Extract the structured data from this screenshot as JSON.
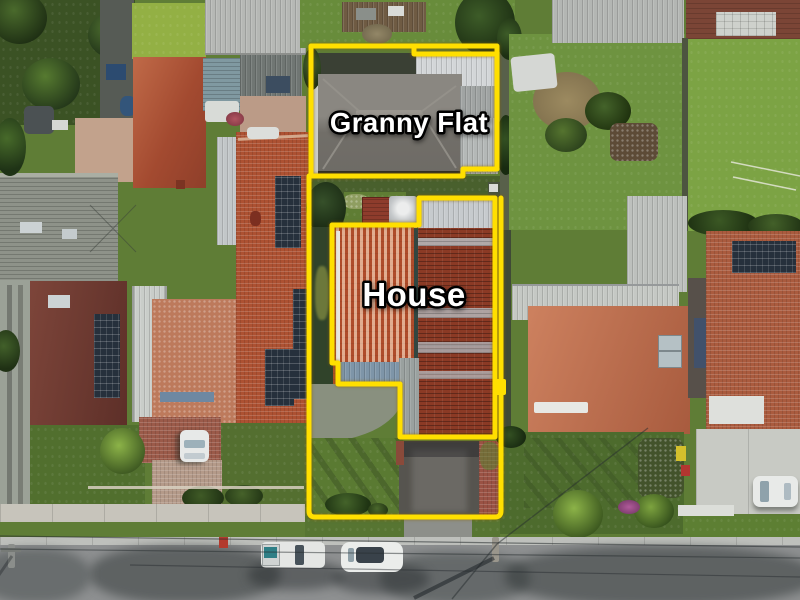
{
  "annotation": {
    "granny_flat_label": "Granny Flat",
    "house_label": "House",
    "outline_color": "#ffdf00",
    "label_fill": "#ffffff",
    "label_stroke": "#000000"
  },
  "palette": {
    "grass-sun": "#6f9440",
    "grass-shade": "#49602d",
    "road": "#8e9091",
    "terracotta": "#b05338",
    "rust-roof": "#8b3a25",
    "gray-roof": "#7b7872",
    "metal-light": "#c6cacd",
    "solar": "#26303c"
  }
}
